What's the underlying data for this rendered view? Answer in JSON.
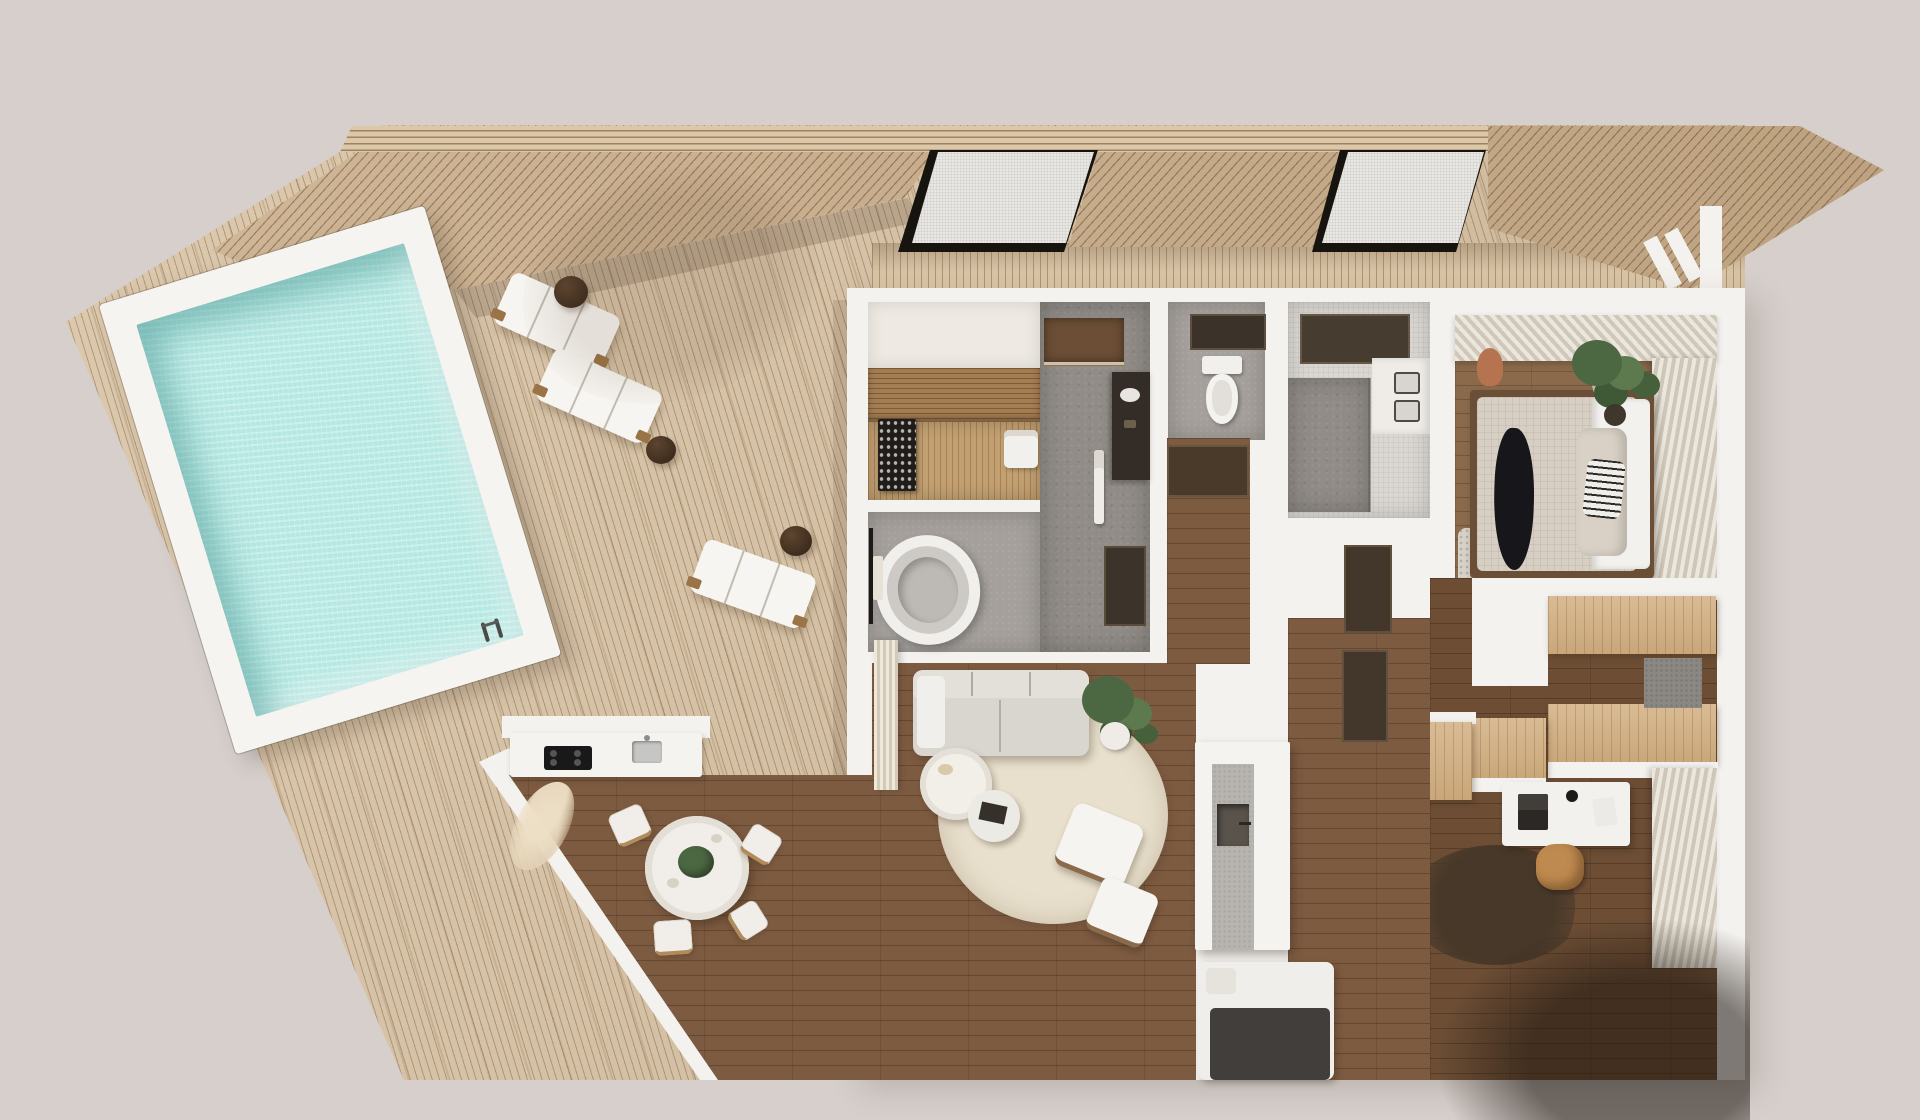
{
  "scene": {
    "type": "3d-architectural-floor-plan-render",
    "view": "top-down",
    "exterior": {
      "deck": {
        "material": "light-wood-slats",
        "rotation_deg": -17
      },
      "pool": {
        "shape": "rectangular",
        "frame": "white",
        "water_color": "#b5e8e2",
        "has_ladder": true
      },
      "loungers": {
        "count": 3,
        "color": "white",
        "side_tables": 2
      },
      "roof": {
        "fascia": "horizontal-wood-strips",
        "panels": "diagonal-wood-slats",
        "skylights": 2
      }
    },
    "rooms": [
      {
        "name": "sauna",
        "furniture": [
          "wood-benches",
          "sauna-heater",
          "towels"
        ]
      },
      {
        "name": "bathroom-with-tub",
        "furniture": [
          "oval-bathtub",
          "towel-rack"
        ]
      },
      {
        "name": "shower-bathroom",
        "furniture": [
          "walk-in-shower",
          "dark-vanity",
          "hanging-towels"
        ]
      },
      {
        "name": "toilet-room",
        "furniture": [
          "toilet"
        ]
      },
      {
        "name": "master-bathroom",
        "furniture": [
          "double-sink-vanity",
          "shower-area"
        ]
      },
      {
        "name": "master-bedroom",
        "furniture": [
          "double-bed",
          "black-throw",
          "striped-pillow",
          "plant",
          "rug",
          "curtains"
        ]
      },
      {
        "name": "walk-in-closet",
        "furniture": [
          "oak-wardrobes",
          "gray-panel"
        ]
      },
      {
        "name": "home-office",
        "furniture": [
          "white-desk",
          "laptop",
          "tan-chair",
          "dark-round-rug",
          "oak-sideboard",
          "curtains"
        ]
      },
      {
        "name": "living-room",
        "furniture": [
          "sofa",
          "cream-round-rug",
          "coffee-tables",
          "armchair-with-ottoman",
          "plant",
          "fireplace-column",
          "curtains"
        ]
      },
      {
        "name": "kitchen-dining",
        "furniture": [
          "counter-with-cooktop-and-sink",
          "round-dining-table",
          "dining-chairs",
          "pampas-decor"
        ]
      },
      {
        "name": "bottom-bedroom",
        "furniture": [
          "bed-with-dark-blanket"
        ]
      }
    ]
  },
  "palette": {
    "bg": "#d6cfcc",
    "deck": "#d9c4a6",
    "roof": "#cdb18e",
    "fascia": "#dcc8a8",
    "glass": "#e9e7e3",
    "houseWall": "#f4f2ef",
    "woodLiving": "#7d5b41",
    "woodDark": "#6d4e35",
    "woodBed": "#8b6a4c",
    "oak": "#d4b285",
    "concrete": "#918c87",
    "grayFloor": "#a5a09c",
    "lightTile": "#dad6d1",
    "saunaWood": "#c2a072",
    "saunaBench": "#a57d53",
    "water": "#b5e8e2",
    "sofa": "#d9d5cf",
    "rugCream": "#e8e0cd",
    "rugDark": "#44362a",
    "tanChair": "#bf8a50",
    "blackAccent": "#17161a",
    "greenPlant": "#4c6842",
    "terracotta": "#b5744f"
  }
}
